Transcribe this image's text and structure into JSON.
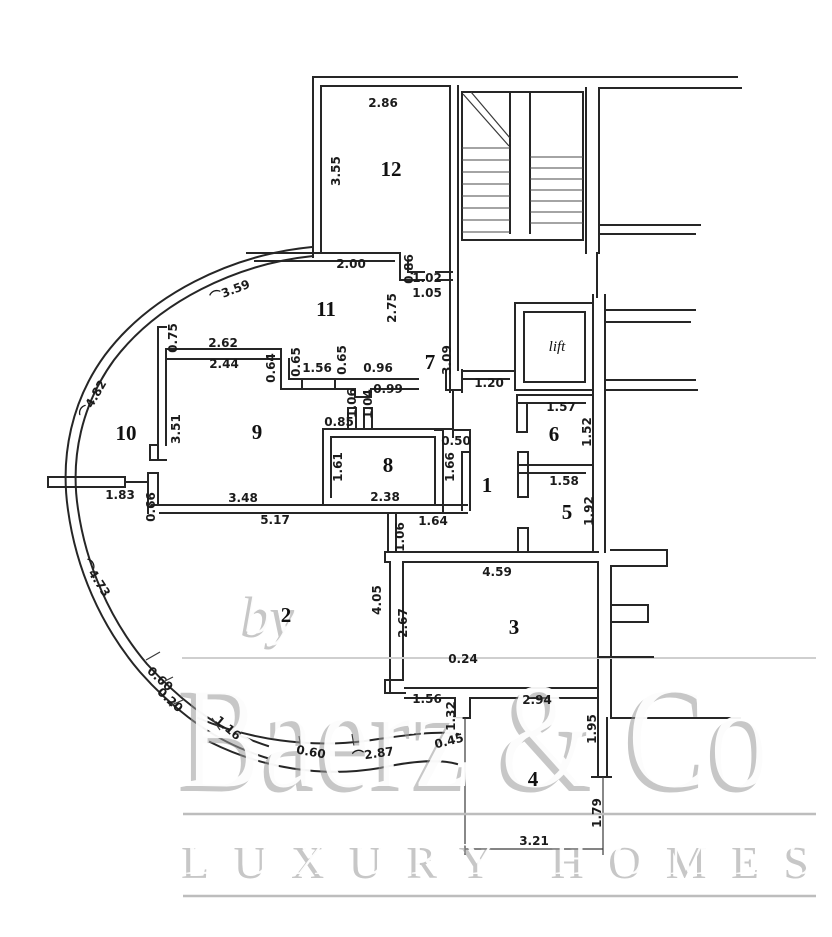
{
  "plan": {
    "rooms": [
      {
        "id": "room-12",
        "label": "12"
      },
      {
        "id": "room-11",
        "label": "11"
      },
      {
        "id": "room-7",
        "label": "7"
      },
      {
        "id": "lift",
        "label": "lift"
      },
      {
        "id": "room-10",
        "label": "10"
      },
      {
        "id": "room-9",
        "label": "9"
      },
      {
        "id": "room-6",
        "label": "6"
      },
      {
        "id": "room-8",
        "label": "8"
      },
      {
        "id": "room-1",
        "label": "1"
      },
      {
        "id": "room-5",
        "label": "5"
      },
      {
        "id": "room-2",
        "label": "2"
      },
      {
        "id": "room-3",
        "label": "3"
      },
      {
        "id": "room-4",
        "label": "4"
      }
    ],
    "dims": [
      "2.86",
      "3.55",
      "2.00",
      "⌒3.59",
      "0.75",
      "2.62",
      "2.44",
      "0.64",
      "0.65",
      "1.56",
      "0.65",
      "0.96",
      "0.99",
      "0.86",
      "1.02",
      "1.05",
      "2.75",
      "3.09",
      "1.20",
      "1.57",
      "1.52",
      "1.58",
      "1.92",
      "⌒4.82",
      "3.51",
      "1.83",
      "0.66",
      "3.48",
      "5.17",
      "0.85",
      "1.06",
      "1.04",
      "1.61",
      "2.38",
      "0.50",
      "1.66",
      "1.64",
      "1.06",
      "⌒4.73",
      "0.60",
      "0.20",
      "4.05",
      "2.67",
      "4.59",
      "0.24",
      "1.56",
      "2.94",
      "1.32",
      "0.45",
      "1.16",
      "0.60",
      "⌒2.87",
      "1.95",
      "1.79",
      "3.21"
    ]
  },
  "watermark": {
    "prefix": "by",
    "brand": "Baerz & Co",
    "tagline": "LUXURY HOMES",
    "rule_color": "#bdbdbd"
  },
  "colors": {
    "wall": "#262626",
    "dim_text": "#1b1b1b",
    "paper": "#ffffff"
  }
}
